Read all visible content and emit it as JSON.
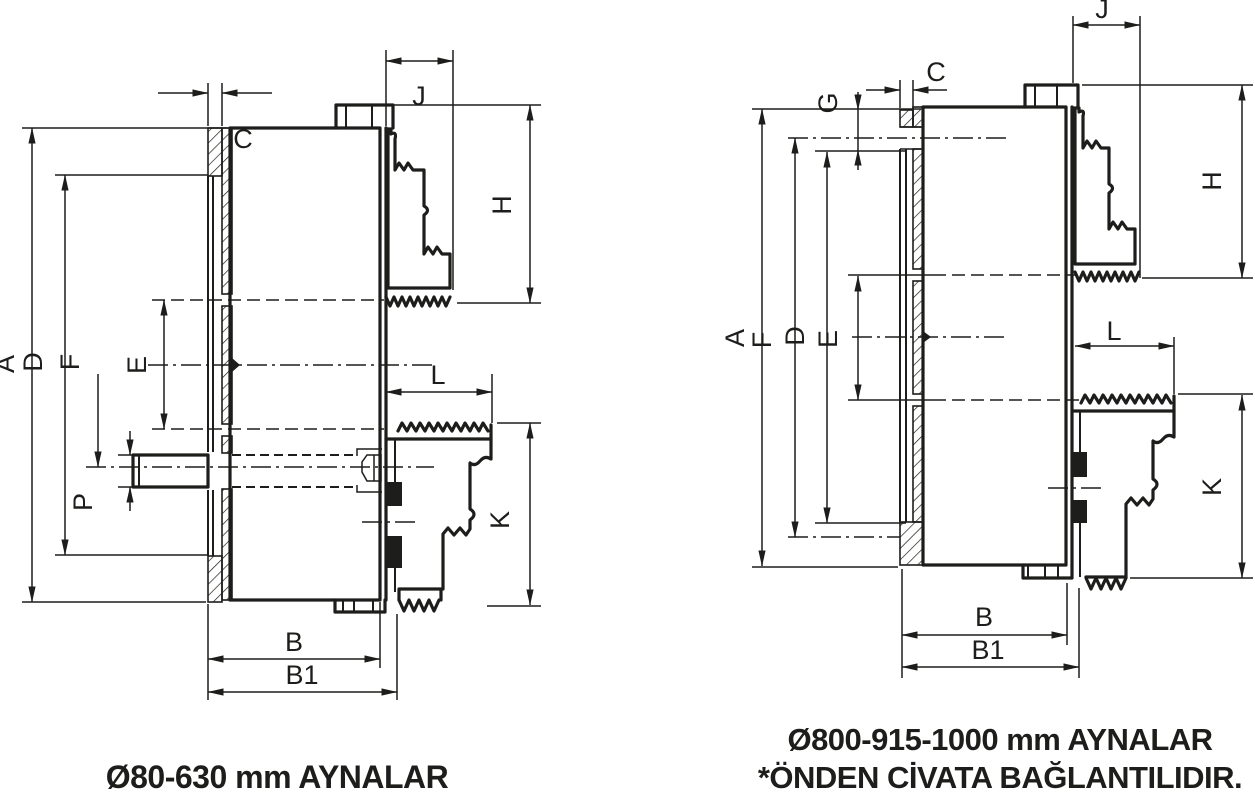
{
  "drawing_title": "Chuck mounting cross-sections",
  "colors": {
    "ink": "#1d1d1b",
    "background": "#ffffff"
  },
  "left_drawing": {
    "caption": "Ø80-630 mm AYNALAR",
    "dim_labels": {
      "A": "A",
      "B": "B",
      "B1": "B1",
      "C": "C",
      "D": "D",
      "E": "E",
      "F": "F",
      "H": "H",
      "J": "J",
      "K": "K",
      "L": "L",
      "P": "P"
    }
  },
  "right_drawing": {
    "caption_line1": "Ø800-915-1000 mm AYNALAR",
    "caption_line2": "*ÖNDEN CİVATA BAĞLANTILIDIR.",
    "dim_labels": {
      "A": "A",
      "B": "B",
      "B1": "B1",
      "C": "C",
      "D": "D",
      "E": "E",
      "F": "F",
      "G": "G",
      "H": "H",
      "J": "J",
      "K": "K",
      "L": "L"
    }
  }
}
